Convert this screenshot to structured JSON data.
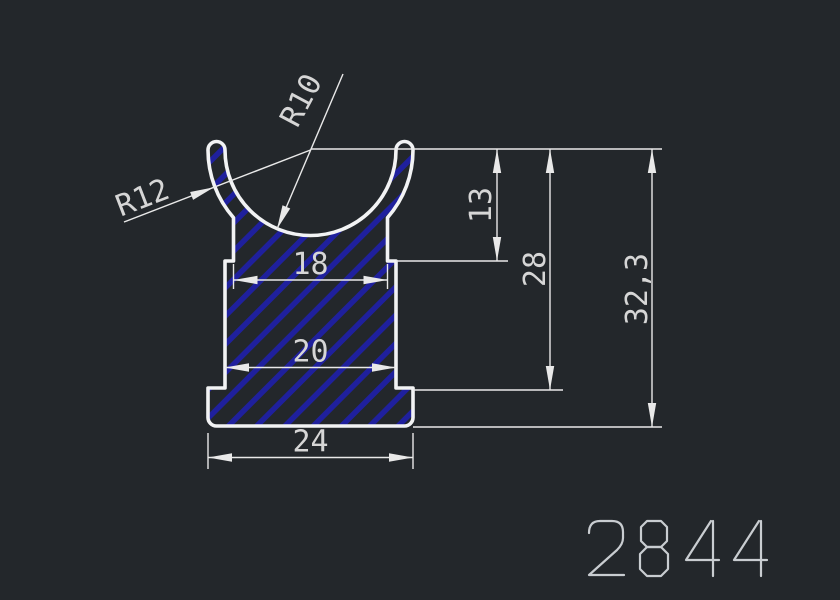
{
  "drawing": {
    "background_color": "#23272b",
    "profile_line_color": "#f2f3f4",
    "hatch_color": "#1f209d",
    "dim_line_color": "#e9e9e9",
    "dim_text_color": "#d6d6d6",
    "part_number_color": "#c9cdd1",
    "dimensions": {
      "width_top": "18",
      "width_middle": "20",
      "width_bottom": "24",
      "height_step": "13",
      "height_body": "28",
      "height_total": "32,3",
      "radius_inner": "R10",
      "radius_outer": "R12"
    },
    "part_number": "2844"
  }
}
